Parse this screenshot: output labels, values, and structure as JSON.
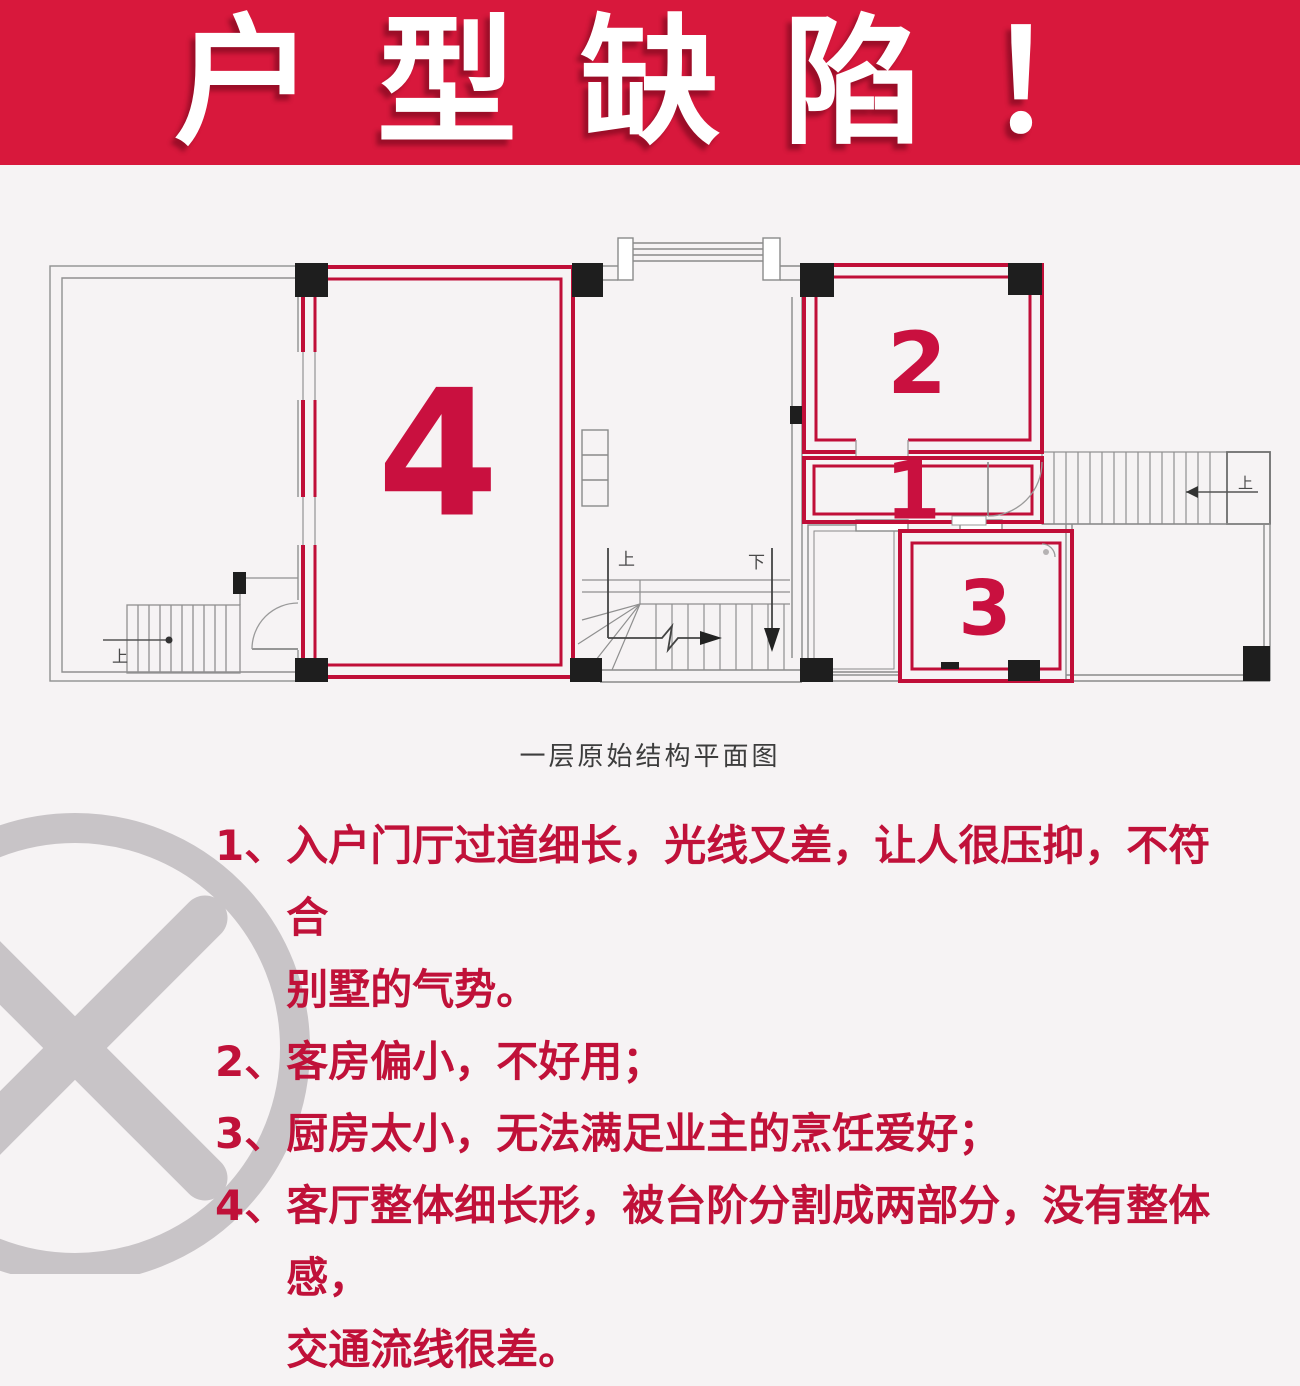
{
  "title": "户型缺陷！",
  "caption": "一层原始结构平面图",
  "colors": {
    "banner_background": "#d8183c",
    "title_text": "#ffffff",
    "plan_wall_red": "#c00e38",
    "room_number_red": "#c9103f",
    "defect_text_red": "#c01139",
    "watermark_gray": "#c8c4c7",
    "page_background": "#f6f3f4"
  },
  "plan_labels": {
    "room1": "1",
    "room2": "2",
    "room3": "3",
    "room4": "4",
    "stair_up_left": "上",
    "stair_up_main": "上",
    "stair_down_main": "下",
    "stair_up_right": "上"
  },
  "defects": [
    {
      "num": "1、",
      "lines": [
        "入户门厅过道细长，光线又差，让人很压抑，不符合",
        "别墅的气势。"
      ]
    },
    {
      "num": "2、",
      "lines": [
        "客房偏小，不好用；"
      ]
    },
    {
      "num": "3、",
      "lines": [
        "厨房太小，无法满足业主的烹饪爱好；"
      ]
    },
    {
      "num": "4、",
      "lines": [
        "客厅整体细长形，被台阶分割成两部分，没有整体感，",
        "交通流线很差。"
      ]
    }
  ]
}
